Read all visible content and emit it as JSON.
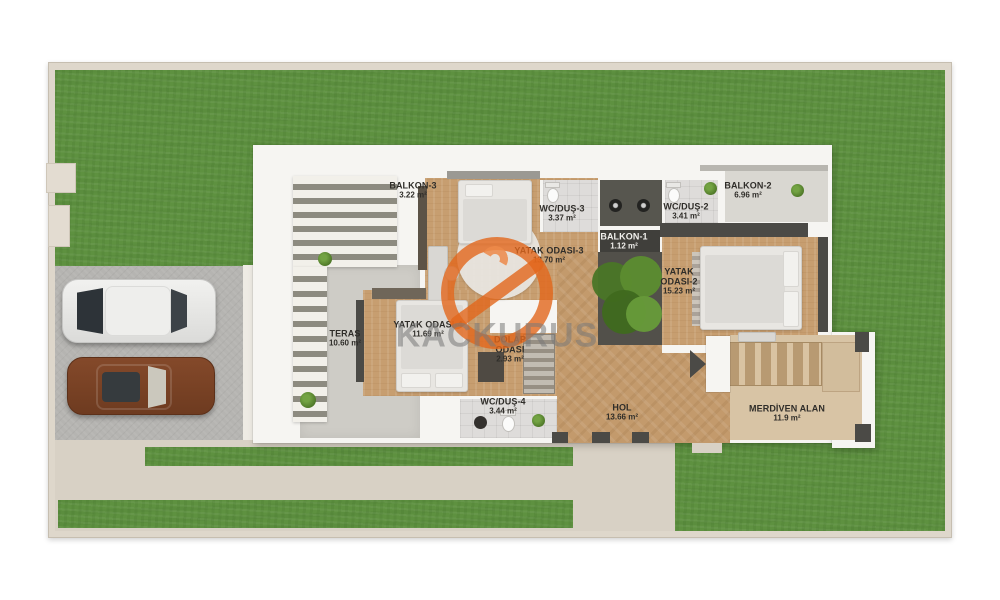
{
  "watermark": {
    "text": "KACKURUS",
    "accent_color": "#e2661b",
    "text_color": "#787878"
  },
  "rooms": [
    {
      "id": "balkon-3",
      "name": "BALKON-3",
      "area": "3.22 m²"
    },
    {
      "id": "wc-dus-3",
      "name": "WC/DUŞ-3",
      "area": "3.37 m²"
    },
    {
      "id": "wc-dus-2",
      "name": "WC/DUŞ-2",
      "area": "3.41 m²"
    },
    {
      "id": "balkon-2",
      "name": "BALKON-2",
      "area": "6.96 m²"
    },
    {
      "id": "balkon-1",
      "name": "BALKON-1",
      "area": "1.12 m²"
    },
    {
      "id": "yatak-3",
      "name": "YATAK ODASI-3",
      "area": "13.70 m²"
    },
    {
      "id": "yatak-2",
      "name": "YATAK ODASI-2",
      "area": "15.23 m²"
    },
    {
      "id": "teras",
      "name": "TERAS",
      "area": "10.60 m²"
    },
    {
      "id": "yatak-4",
      "name": "YATAK ODASI-4",
      "area": "11.69 m²"
    },
    {
      "id": "dolap",
      "name": "DOLAP ODASI",
      "area": "2.93 m²"
    },
    {
      "id": "wc-dus-4",
      "name": "WC/DUŞ-4",
      "area": "3.44 m²"
    },
    {
      "id": "hol",
      "name": "HOL",
      "area": "13.66 m²"
    },
    {
      "id": "merdiven",
      "name": "MERDİVEN ALAN",
      "area": "11.9 m²"
    }
  ],
  "colors": {
    "grass": "#5e9140",
    "wood_floor": "#c79e70",
    "wall_dark": "#4b4a46",
    "driveway": "#b5b4b1",
    "walkway": "#d8d1c5",
    "tile": "#dedcda",
    "stairs_wood": "#d8c4a5",
    "watermark_orange": "#e2661b"
  }
}
